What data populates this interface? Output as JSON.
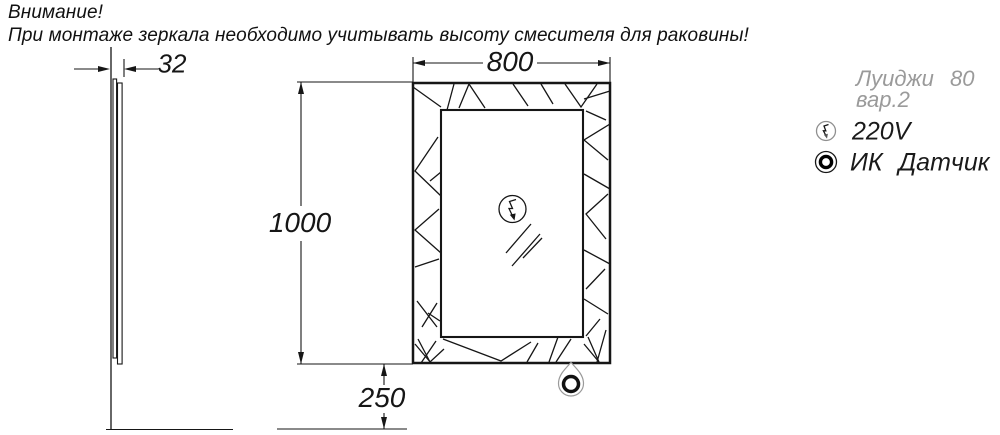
{
  "warning": {
    "line1": "Внимание!",
    "line2": "При монтаже зеркала необходимо учитывать высоту смесителя для раковины!"
  },
  "drawing": {
    "model": "Луиджи 80",
    "variant": "вар.2",
    "dimensions": {
      "depth_mm": "32",
      "width_mm": "800",
      "height_mm": "1000",
      "sensor_height_mm": "250"
    },
    "legend": [
      {
        "icon": "lightning-circle-icon",
        "label": "220V"
      },
      {
        "icon": "ir-sensor-icon",
        "label": "ИК Датчик"
      }
    ],
    "colors": {
      "line": "#161616",
      "muted_text": "#9a9a9a",
      "background": "#ffffff"
    }
  }
}
